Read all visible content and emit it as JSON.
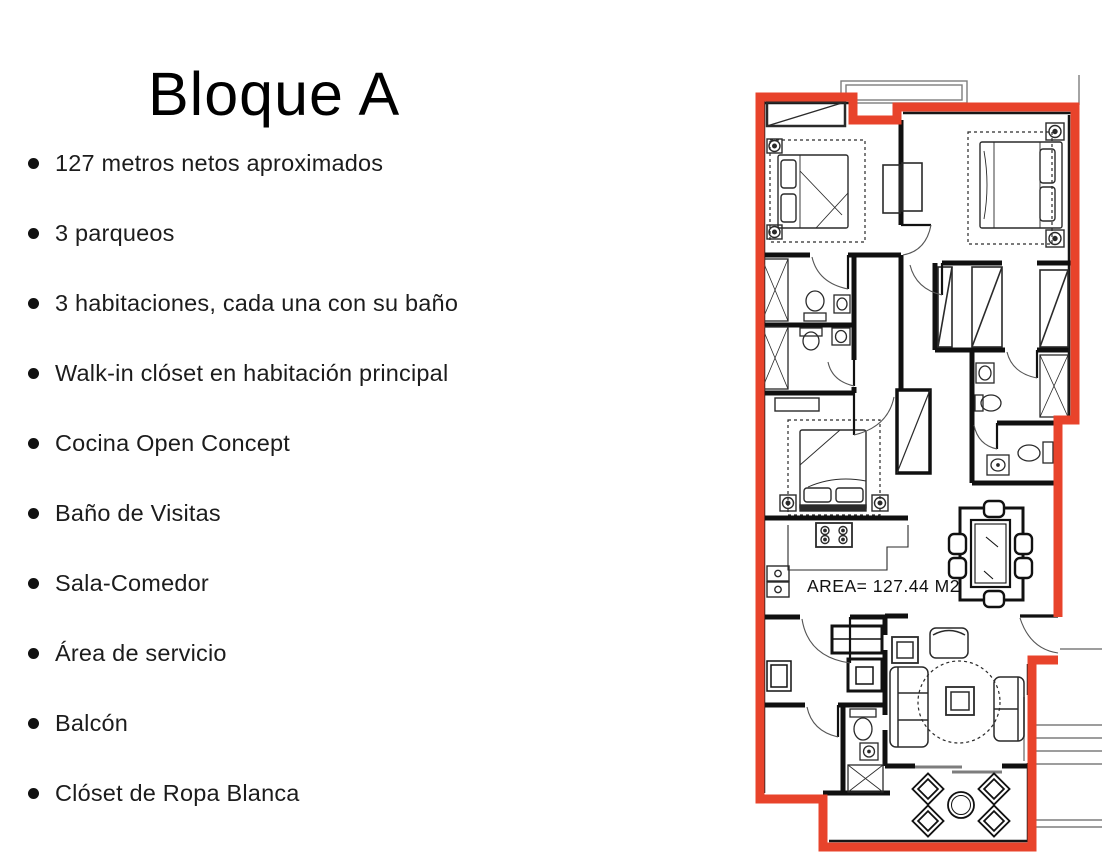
{
  "page": {
    "background": "#ffffff"
  },
  "header": {
    "title": "Bloque A"
  },
  "features": [
    "127 metros netos aproximados",
    "3 parqueos",
    "3 habitaciones, cada una con su baño",
    "Walk-in clóset en habitación principal",
    "Cocina Open Concept",
    "Baño de Visitas",
    "Sala-Comedor",
    "Área de servicio",
    "Balcón",
    "Clóset de Ropa Blanca"
  ],
  "floorplan": {
    "area_label": "AREA= 127.44 M2",
    "outline_color": "#e8432b"
  }
}
